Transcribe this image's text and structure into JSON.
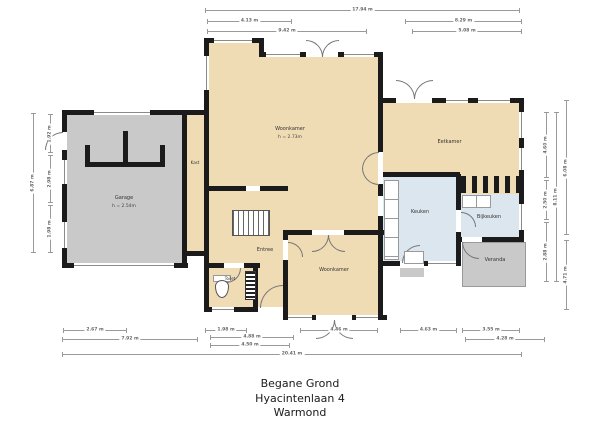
{
  "title": [
    "Begane Grond",
    "Hyacintenlaan 4",
    "Warmond"
  ],
  "rooms": {
    "garage": {
      "name": "Garage",
      "note": "h = 2.54m"
    },
    "kast": {
      "name": "Kast"
    },
    "woonkamer": {
      "name": "Woonkamer",
      "note": "h = 2.73m"
    },
    "eetkamer": {
      "name": "Eetkamer"
    },
    "keuken": {
      "name": "Keuken"
    },
    "bijkeuken": {
      "name": "Bijkeuken"
    },
    "veranda": {
      "name": "Veranda"
    },
    "woonkamer2": {
      "name": "Woonkamer"
    },
    "entree": {
      "name": "Entree"
    },
    "toilet": {
      "name": "Toilet"
    }
  },
  "dims": {
    "top": {
      "total": "17.94 m",
      "left_a": "4.13 m",
      "left_b": "9.42 m",
      "right_a": "8.29 m",
      "right_b": "5.08 m"
    },
    "bottom": {
      "garage_a": "2.67 m",
      "garage_b": "7.92 m",
      "mid_a": "1.98 m",
      "mid_b": "4.88 m",
      "mid_c": "4.50 m",
      "center": "4.46 m",
      "right_a": "4.63 m",
      "right_b": "3.55 m",
      "right_c": "4.28 m",
      "total": "20.41 m"
    },
    "left": {
      "total": "6.87 m",
      "a": "1.92 m",
      "b": "2.98 m",
      "c": "1.98 m"
    },
    "right": {
      "a": "4.60 m",
      "b": "2.50 m",
      "c": "2.88 m",
      "total": "8.11 m",
      "lower": "4.71 m",
      "outer": "6.08 m"
    }
  },
  "colors": {
    "room_tan": "#f0dcb4",
    "room_gray": "#c9c9c9",
    "room_blue": "#dbe6ef",
    "wall": "#1b1b1b",
    "dim": "#9a9a9a"
  }
}
